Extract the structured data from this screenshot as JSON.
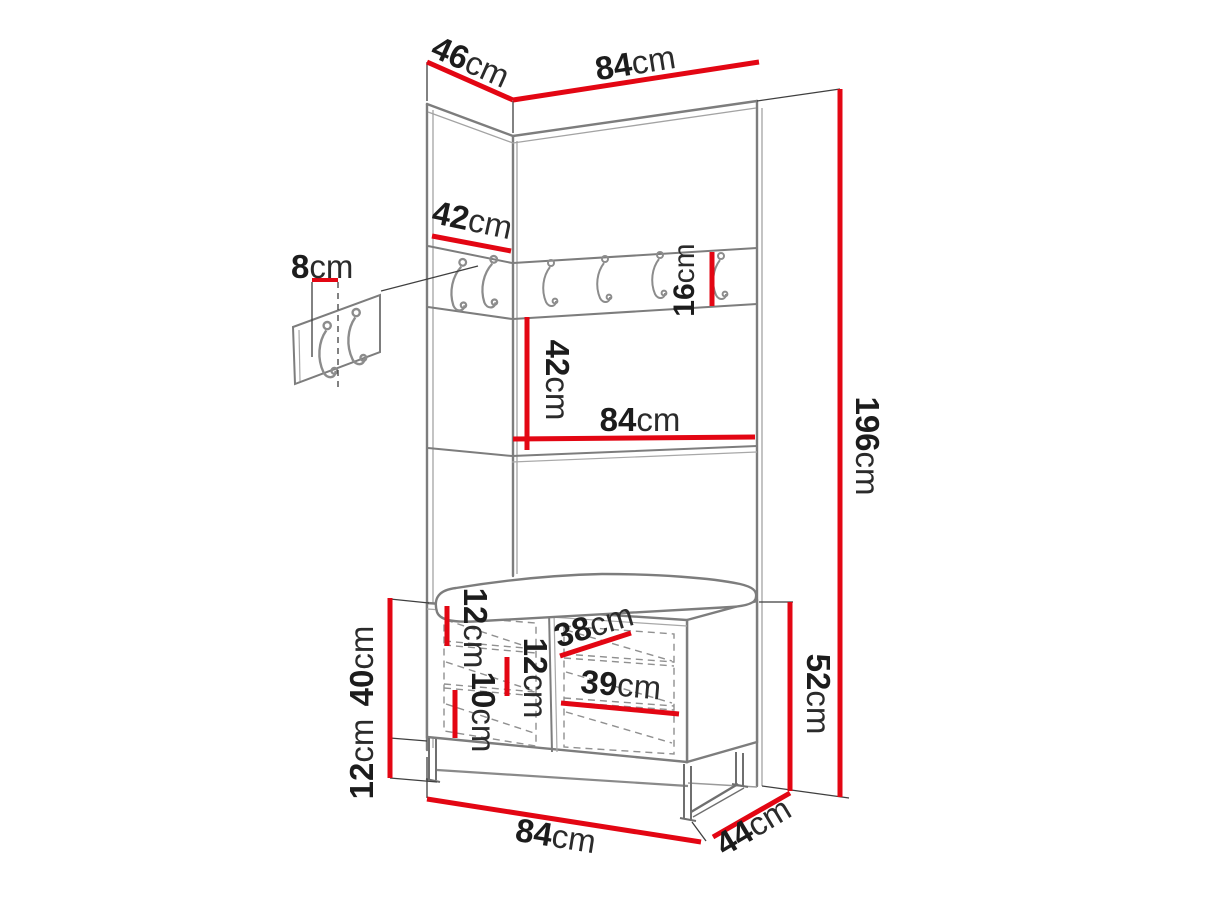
{
  "diagram": {
    "type": "furniture-dimension-drawing",
    "subject": "hallway wardrobe panel with coat hook rail, shelf and shoe bench with cushion",
    "style": "grey line-art with red dimension lines",
    "colors": {
      "background": "#ffffff",
      "dimension_line": "#e30613",
      "outline": "#7d7d7d",
      "label_text": "#1c1c1c"
    },
    "hooks": {
      "rail_side_count": 2,
      "rail_front_count": 4,
      "detail_panel_count": 2
    }
  },
  "dims": {
    "top_depth": {
      "value": "46",
      "unit": "cm"
    },
    "top_width": {
      "value": "84",
      "unit": "cm"
    },
    "side_panel_height": {
      "value": "42",
      "unit": "cm"
    },
    "hook_offset": {
      "value": "8",
      "unit": "cm"
    },
    "hook_rail_height": {
      "value": "16",
      "unit": "cm"
    },
    "rail_to_shelf": {
      "value": "42",
      "unit": "cm"
    },
    "shelf_width": {
      "value": "84",
      "unit": "cm"
    },
    "total_height": {
      "value": "196",
      "unit": "cm"
    },
    "bench_inner_top": {
      "value": "12",
      "unit": "cm"
    },
    "bench_inner_middle": {
      "value": "12",
      "unit": "cm"
    },
    "bench_inner_bottom": {
      "value": "10",
      "unit": "cm"
    },
    "bench_inner_width_upper": {
      "value": "38",
      "unit": "cm"
    },
    "bench_inner_width_lower": {
      "value": "39",
      "unit": "cm"
    },
    "bench_body_height": {
      "value": "40",
      "unit": "cm"
    },
    "bench_leg_height": {
      "value": "12",
      "unit": "cm"
    },
    "bench_total_height": {
      "value": "52",
      "unit": "cm"
    },
    "bench_width": {
      "value": "84",
      "unit": "cm"
    },
    "bench_depth": {
      "value": "44",
      "unit": "cm"
    }
  }
}
